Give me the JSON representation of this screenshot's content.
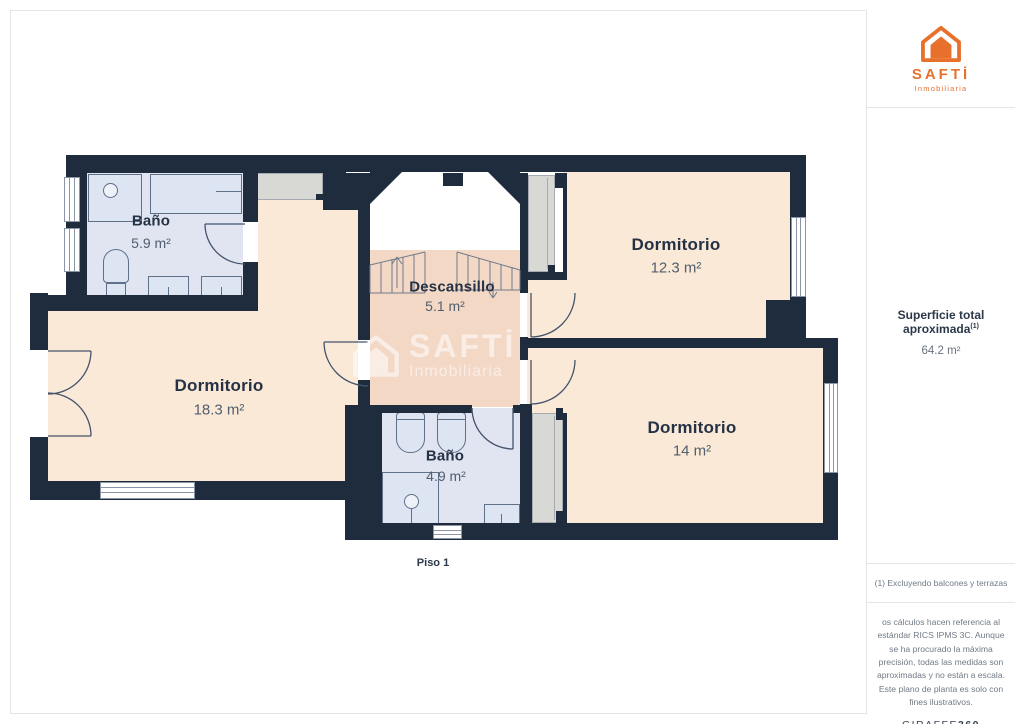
{
  "sidebar": {
    "brand": {
      "name": "SAFTİ",
      "tagline": "Inmobiliaria"
    },
    "total_area": {
      "label": "Superficie total aproximada",
      "superscript": "(1)",
      "value": "64.2 m²"
    },
    "footnote": "(1) Excluyendo balcones y terrazas",
    "disclaimer": "os cálculos hacen referencia al estándar RICS IPMS 3C. Aunque se ha procurado la máxima precisión, todas las medidas son aproximadas y no están a escala. Este plano de planta es solo con fines ilustrativos.",
    "provider": {
      "name": "GIRAFFE",
      "suffix": "360"
    }
  },
  "floorplan": {
    "floor_label": "Piso 1",
    "watermark": {
      "brand": "SAFTİ",
      "tagline": "Inmobiliaria"
    },
    "rooms": [
      {
        "name": "Baño",
        "area": "5.9 m²"
      },
      {
        "name": "Dormitorio",
        "area": "12.3 m²"
      },
      {
        "name": "Descansillo",
        "area": "5.1 m²"
      },
      {
        "name": "Dormitorio",
        "area": "18.3 m²"
      },
      {
        "name": "Dormitorio",
        "area": "14 m²"
      },
      {
        "name": "Baño",
        "area": "4.9 m²"
      }
    ],
    "colors": {
      "brand_orange": "#e8702d",
      "wall": "#1f2c3d",
      "bedroom_floor": "#fbe9d7",
      "bathroom_floor": "#e0e5f1",
      "landing_floor": "#f3d8c6",
      "closet": "#d8d8d4"
    }
  }
}
